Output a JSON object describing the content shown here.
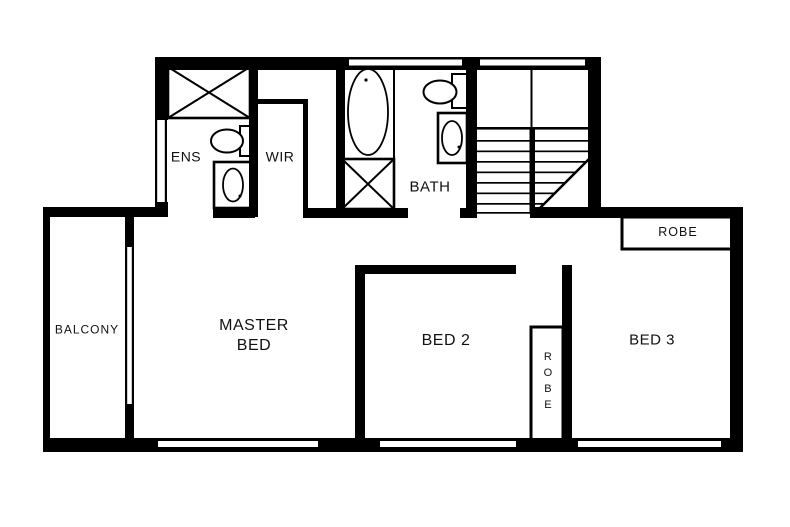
{
  "title": "upper-floor-plan",
  "colors": {
    "background": "#ffffff",
    "wall": "#000000",
    "text": "#111111"
  },
  "rooms": {
    "balcony": {
      "label": "BALCONY"
    },
    "master_bed": {
      "line1": "MASTER",
      "line2": "BED"
    },
    "ens": {
      "label": "ENS"
    },
    "wir": {
      "label": "WIR"
    },
    "bath": {
      "label": "BATH"
    },
    "bed2": {
      "label": "BED 2"
    },
    "bed3": {
      "label": "BED 3"
    }
  },
  "storage": {
    "bed3_robe_label": "ROBE",
    "bed2_robe_label": "ROBE"
  },
  "fixtures": {
    "ens": {
      "shower": "shower-cubicle",
      "toilet": "toilet",
      "basin": "vanity-basin"
    },
    "bath": {
      "tub": "bathtub",
      "shower": "shower-cubicle",
      "toilet": "toilet",
      "basin": "vanity-basin"
    },
    "stairs": "staircase",
    "balcony_door": "sliding-door"
  }
}
